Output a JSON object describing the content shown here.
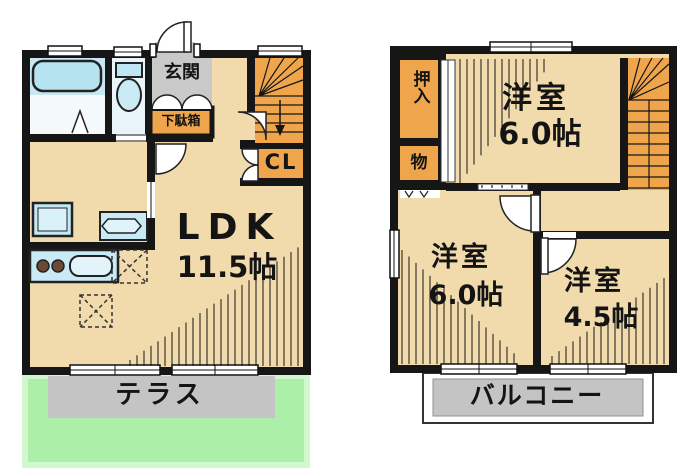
{
  "floor1": {
    "genkan": "玄関",
    "getabako": "下駄箱",
    "closet": "CL",
    "ldk": "LDK",
    "ldk_size": "11.5帖",
    "terrace": "テラス"
  },
  "floor2": {
    "oshiire": "押入",
    "storage": "物",
    "room_top": "洋室",
    "room_top_size": "6.0帖",
    "room_left": "洋室",
    "room_left_size": "6.0帖",
    "room_right": "洋室",
    "room_right_size": "4.5帖",
    "balcony": "バルコニー"
  },
  "colors": {
    "wall": "#161616",
    "floor_beige": "#F1DAAC",
    "closet_orange": "#EFA54C",
    "fixture_blue": "#C9EAF5",
    "entrance_gray": "#C9C9C9",
    "terrace_gray": "#C4C4C4",
    "lawn_green": "#ABEFA9"
  }
}
